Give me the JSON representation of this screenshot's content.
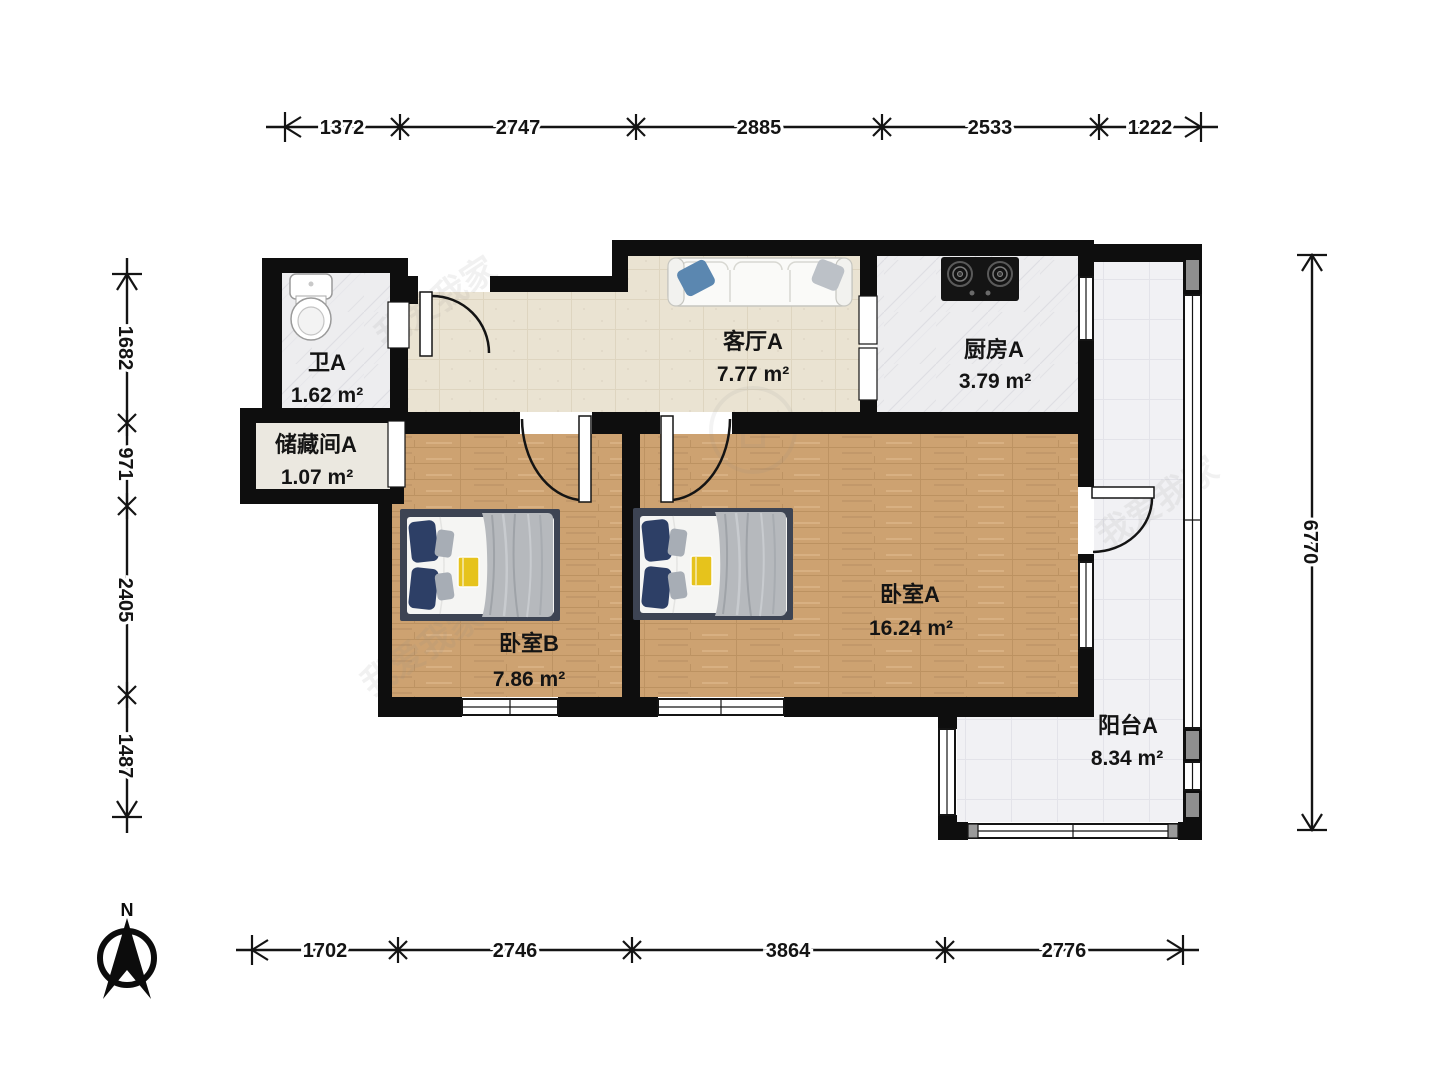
{
  "rooms": [
    {
      "name": "卫A",
      "area": "1.62 m²"
    },
    {
      "name": "储藏间A",
      "area": "1.07 m²"
    },
    {
      "name": "客厅A",
      "area": "7.77 m²"
    },
    {
      "name": "厨房A",
      "area": "3.79 m²"
    },
    {
      "name": "卧室B",
      "area": "7.86 m²"
    },
    {
      "name": "卧室A",
      "area": "16.24 m²"
    },
    {
      "name": "阳台A",
      "area": "8.34 m²"
    }
  ],
  "dimensions": {
    "top": [
      "1372",
      "2747",
      "2885",
      "2533",
      "1222"
    ],
    "left": [
      "1682",
      "971",
      "2405",
      "1487"
    ],
    "right": [
      "6770"
    ],
    "bottom": [
      "1702",
      "2746",
      "3864",
      "2776"
    ]
  },
  "compass": {
    "label": "N"
  },
  "watermark": {
    "text": "我爱我家"
  },
  "colors": {
    "wall": "#0e0e0e",
    "wood_floor": "#cda271",
    "tile_beige": "#eae3d2",
    "tile_marble": "#ededef",
    "tile_balcony": "#f1f1f4",
    "bed_frame": "#3d4453",
    "pillow_navy": "#2d3f66",
    "blanket_gray": "#b6b9bd",
    "sofa_pillow_blue": "#5b87b0",
    "book_yellow": "#e6c31c",
    "pillar_gray": "#8f8f8f"
  }
}
